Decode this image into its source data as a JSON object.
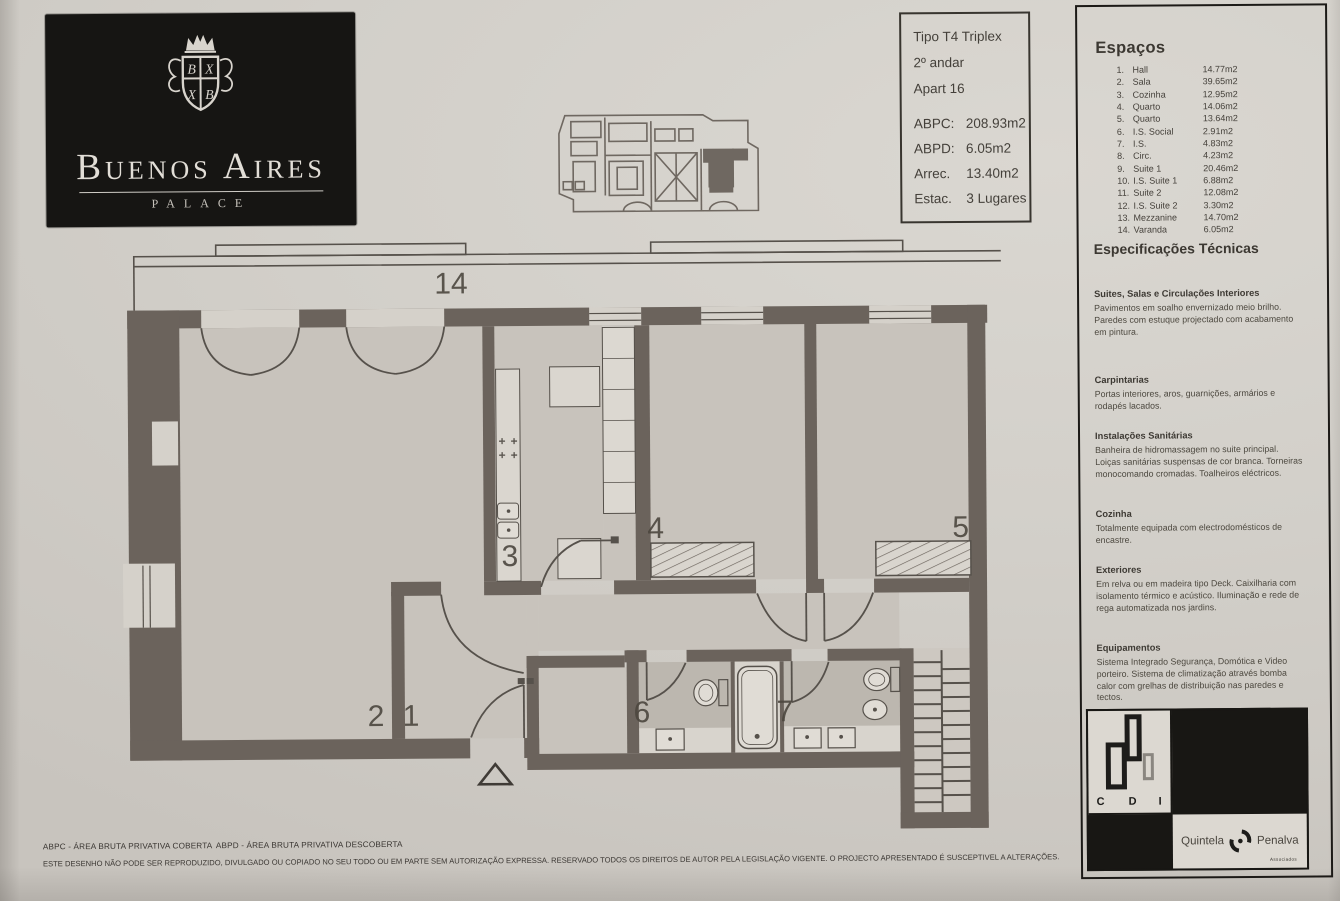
{
  "colors": {
    "paper": "#d2cfc9",
    "wall": "#6b635c",
    "ink": "#44403a",
    "black": "#181714"
  },
  "logo": {
    "name": "Buenos Aires",
    "subtitle": "PALACE"
  },
  "info_box": {
    "lines": [
      "Tipo T4 Triplex",
      "2º andar",
      "Apart 16"
    ],
    "metrics": [
      {
        "label": "ABPC:",
        "value": "208.93m2"
      },
      {
        "label": "ABPD:",
        "value": "6.05m2"
      },
      {
        "label": "Arrec.",
        "value": "13.40m2"
      },
      {
        "label": "Estac.",
        "value": "3 Lugares"
      }
    ]
  },
  "spaces": {
    "title": "Espaços",
    "items": [
      {
        "n": "1.",
        "name": "Hall",
        "area": "14.77m2"
      },
      {
        "n": "2.",
        "name": "Sala",
        "area": "39.65m2"
      },
      {
        "n": "3.",
        "name": "Cozinha",
        "area": "12.95m2"
      },
      {
        "n": "4.",
        "name": "Quarto",
        "area": "14.06m2"
      },
      {
        "n": "5.",
        "name": "Quarto",
        "area": "13.64m2"
      },
      {
        "n": "6.",
        "name": "I.S. Social",
        "area": "2.91m2"
      },
      {
        "n": "7.",
        "name": "I.S.",
        "area": "4.83m2"
      },
      {
        "n": "8.",
        "name": "Circ.",
        "area": "4.23m2"
      },
      {
        "n": "9.",
        "name": "Suite 1",
        "area": "20.46m2"
      },
      {
        "n": "10.",
        "name": "I.S. Suite 1",
        "area": "6.88m2"
      },
      {
        "n": "11.",
        "name": "Suite 2",
        "area": "12.08m2"
      },
      {
        "n": "12.",
        "name": "I.S. Suite 2",
        "area": "3.30m2"
      },
      {
        "n": "13.",
        "name": "Mezzanine",
        "area": "14.70m2"
      },
      {
        "n": "14.",
        "name": "Varanda",
        "area": "6.05m2"
      }
    ]
  },
  "specs": {
    "title": "Especificações Técnicas",
    "sections": [
      {
        "heading": "Suites, Salas e Circulações Interiores",
        "body": "Pavimentos em soalho envernizado meio brilho. Paredes com estuque projectado com acabamento em pintura."
      },
      {
        "heading": "Carpintarias",
        "body": "Portas interiores, aros, guarnições, armários e rodapés lacados."
      },
      {
        "heading": "Instalações Sanitárias",
        "body": "Banheira de hidromassagem no suite principal. Loiças sanitárias suspensas de cor branca. Torneiras monocomando cromadas. Toalheiros eléctricos."
      },
      {
        "heading": "Cozinha",
        "body": "Totalmente equipada com electrodomésticos de encastre."
      },
      {
        "heading": "Exteriores",
        "body": "Em relva ou em madeira tipo Deck. Caixilharia com isolamento térmico e acústico. Iluminação e rede de rega automatizada nos jardins."
      },
      {
        "heading": "Equipamentos",
        "body": "Sistema Integrado Segurança, Domótica e Video porteiro. Sistema de climatização através bomba calor com grelhas de distribuição nas paredes e tectos."
      }
    ]
  },
  "logos": {
    "cdi_letters": [
      "C",
      "D",
      "I"
    ],
    "quintela": "Quintela",
    "penalva": "Penalva",
    "penalva_sub": "Associados"
  },
  "footer": {
    "abbr1": "ABPC - ÁREA BRUTA PRIVATIVA COBERTA",
    "abbr2": "ABPD - ÁREA BRUTA PRIVATIVA DESCOBERTA",
    "disclaimer": "ESTE DESENHO NÃO PODE SER REPRODUZIDO, DIVULGADO OU COPIADO NO SEU TODO OU EM PARTE SEM AUTORIZAÇÃO EXPRESSA. RESERVADO TODOS OS DIREITOS DE AUTOR PELA LEGISLAÇÃO VIGENTE. O PROJECTO APRESENTADO É SUSCEPTIVEL A ALTERAÇÕES."
  },
  "floor_plan": {
    "labels": {
      "balcony": "14",
      "kitchen": "3",
      "room4": "4",
      "room5": "5",
      "sala": "2",
      "hall": "1",
      "bath6": "6",
      "bath7": "7"
    }
  }
}
